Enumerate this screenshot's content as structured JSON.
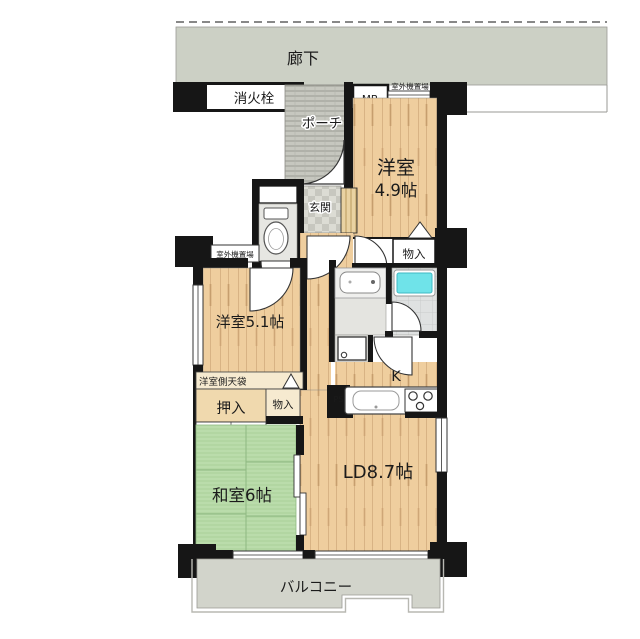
{
  "plan": {
    "corridor": "廊下",
    "fire_hydrant": "消火栓",
    "porch": "ポーチ",
    "meter_box": "MB",
    "outdoor_unit_top": "室外機置場",
    "counter": "カウンター",
    "room49_l1": "洋室",
    "room49_l2": "4.9帖",
    "entrance": "玄関",
    "closet_right": "物入",
    "outdoor_unit_left": "室外機置場",
    "room51": "洋室5.1帖",
    "overhead_cupboard": "洋室側天袋",
    "oshiire": "押入",
    "closet_left": "物入",
    "kitchen": "K",
    "pipe_space": "PS",
    "living_dining": "LD8.7帖",
    "japanese_room": "和室6帖",
    "balcony": "バルコニー"
  },
  "colors": {
    "wood": "#efce9e",
    "wood_line": "#d8b384",
    "tatami": "#badcab",
    "tatami_line": "#8fb982",
    "concrete": "#ccd0c5",
    "balcony": "#d2d4cb",
    "tile_light": "#dcdcd4",
    "tile_dark": "#c7c7bf",
    "bathtub": "#6fe3e9",
    "wall": "#161616"
  }
}
